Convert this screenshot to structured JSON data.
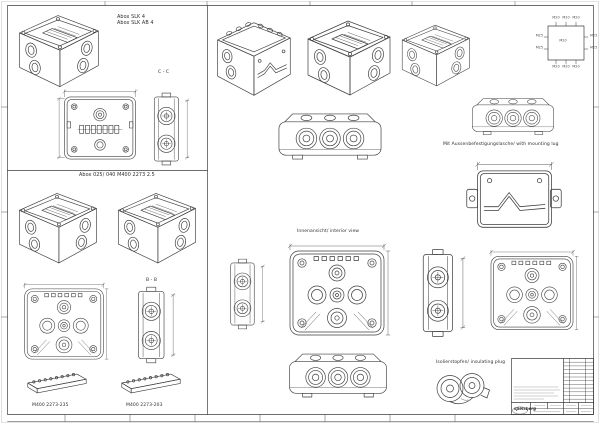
{
  "drawing": {
    "colors": {
      "ink": "#3a3a3a",
      "paper": "#ffffff",
      "faint": "#9a9a9a"
    },
    "labels": {
      "model_a": "Abox SLK 4",
      "model_b": "Abox SLK AB 4",
      "section_cc": "C - C",
      "series_title": "Abox 025/ 040 M400 2273 2.5",
      "section_bb": "B - B",
      "part_left": "M400 2273-235",
      "part_right": "M400 2273-203",
      "interior_note": "Innenansicht/ interior view",
      "mounting_note": "Mit Aussenbefestigungslasche/ with mounting lug",
      "plug_note": "Isolierstopfen/ insulating plug"
    },
    "knockouts": {
      "top": [
        "M20",
        "M20",
        "M20"
      ],
      "bottom": [
        "M20",
        "M20",
        "M20"
      ],
      "left": [
        "M25",
        "M25"
      ],
      "right": [
        "M25",
        "M25"
      ],
      "center": "M20"
    },
    "title_block": {
      "logo": "spelsberg"
    }
  }
}
